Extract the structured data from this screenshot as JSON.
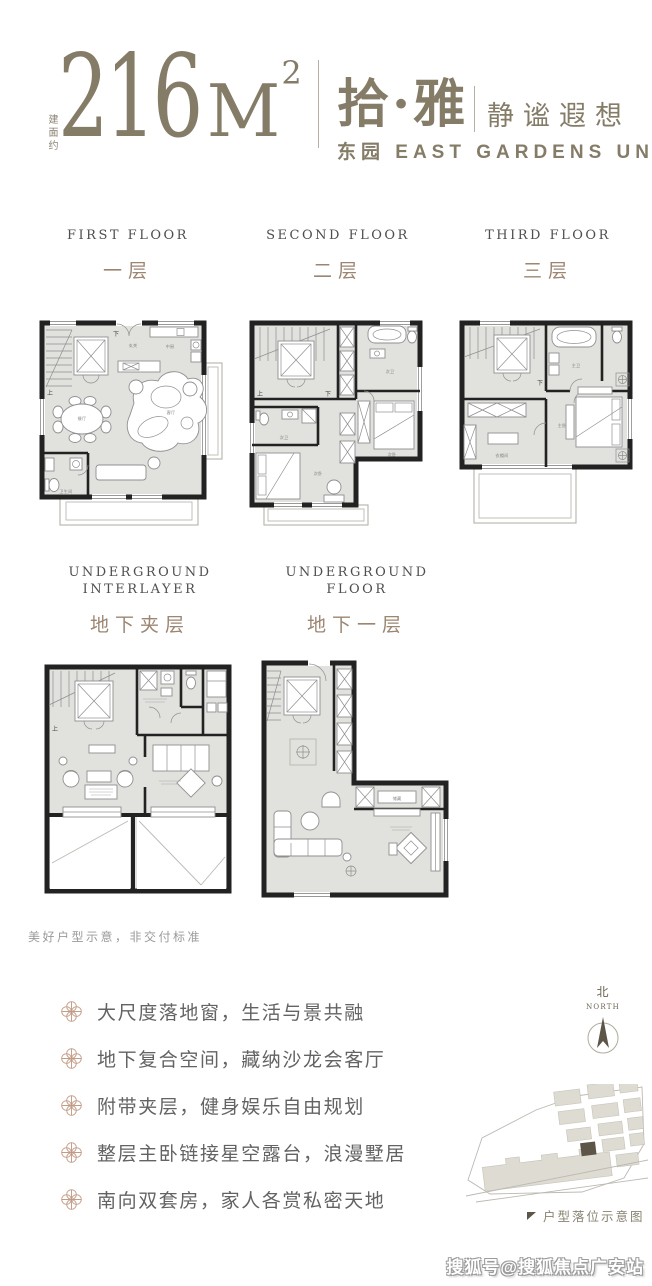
{
  "header": {
    "area_prefix": "建面约",
    "area_number": "216",
    "area_unit": "M",
    "area_sup": "2",
    "name_cn": "拾·雅",
    "tagline": "静谧遐想",
    "subtitle": "东园 EAST GARDENS UNIT4"
  },
  "floors": [
    {
      "en": "FIRST FLOOR",
      "cn": "一层"
    },
    {
      "en": "SECOND FLOOR",
      "cn": "二层"
    },
    {
      "en": "THIRD FLOOR",
      "cn": "三层"
    },
    {
      "en_line1": "UNDERGROUND",
      "en_line2": "INTERLAYER",
      "cn": "地下夹层"
    },
    {
      "en_line1": "UNDERGROUND",
      "en_line2": "FLOOR",
      "cn": "地下一层"
    }
  ],
  "plans": {
    "stair_up": "上",
    "stair_down": "下",
    "first": {
      "entrance": "玄关",
      "kitchen": "中厨",
      "dining": "餐厅",
      "living": "客厅",
      "toilet": "卫生间"
    },
    "second": {
      "bath_top": "次卫",
      "bedroom_right": "次卧",
      "bath_mid": "次卫",
      "bedroom_bottom": "次卧"
    },
    "third": {
      "master_bath": "主卫",
      "master_bedroom": "主卧",
      "cloakroom": "衣帽间"
    },
    "underground": {
      "storeroom": "储藏"
    }
  },
  "note": "美好户型示意，非交付标准",
  "features": [
    "大尺度落地窗，生活与景共融",
    "地下复合空间，藏纳沙龙会客厅",
    "附带夹层，健身娱乐自由规划",
    "整层主卧链接星空露台，浪漫墅居",
    "南向双套房，家人各赏私密天地"
  ],
  "compass": {
    "cn": "北",
    "en": "NORTH"
  },
  "siteplan_caption": "户型落位示意图",
  "watermark": "搜狐号@搜狐焦点广安站",
  "colors": {
    "brand": "#857c68",
    "cn_label": "#9c8672",
    "bullet_icon": "#c29b85",
    "wall": "#222222",
    "floor_fill": "#e1e1dd",
    "site_building": "#dedbd3",
    "site_highlight": "#5d5547"
  }
}
